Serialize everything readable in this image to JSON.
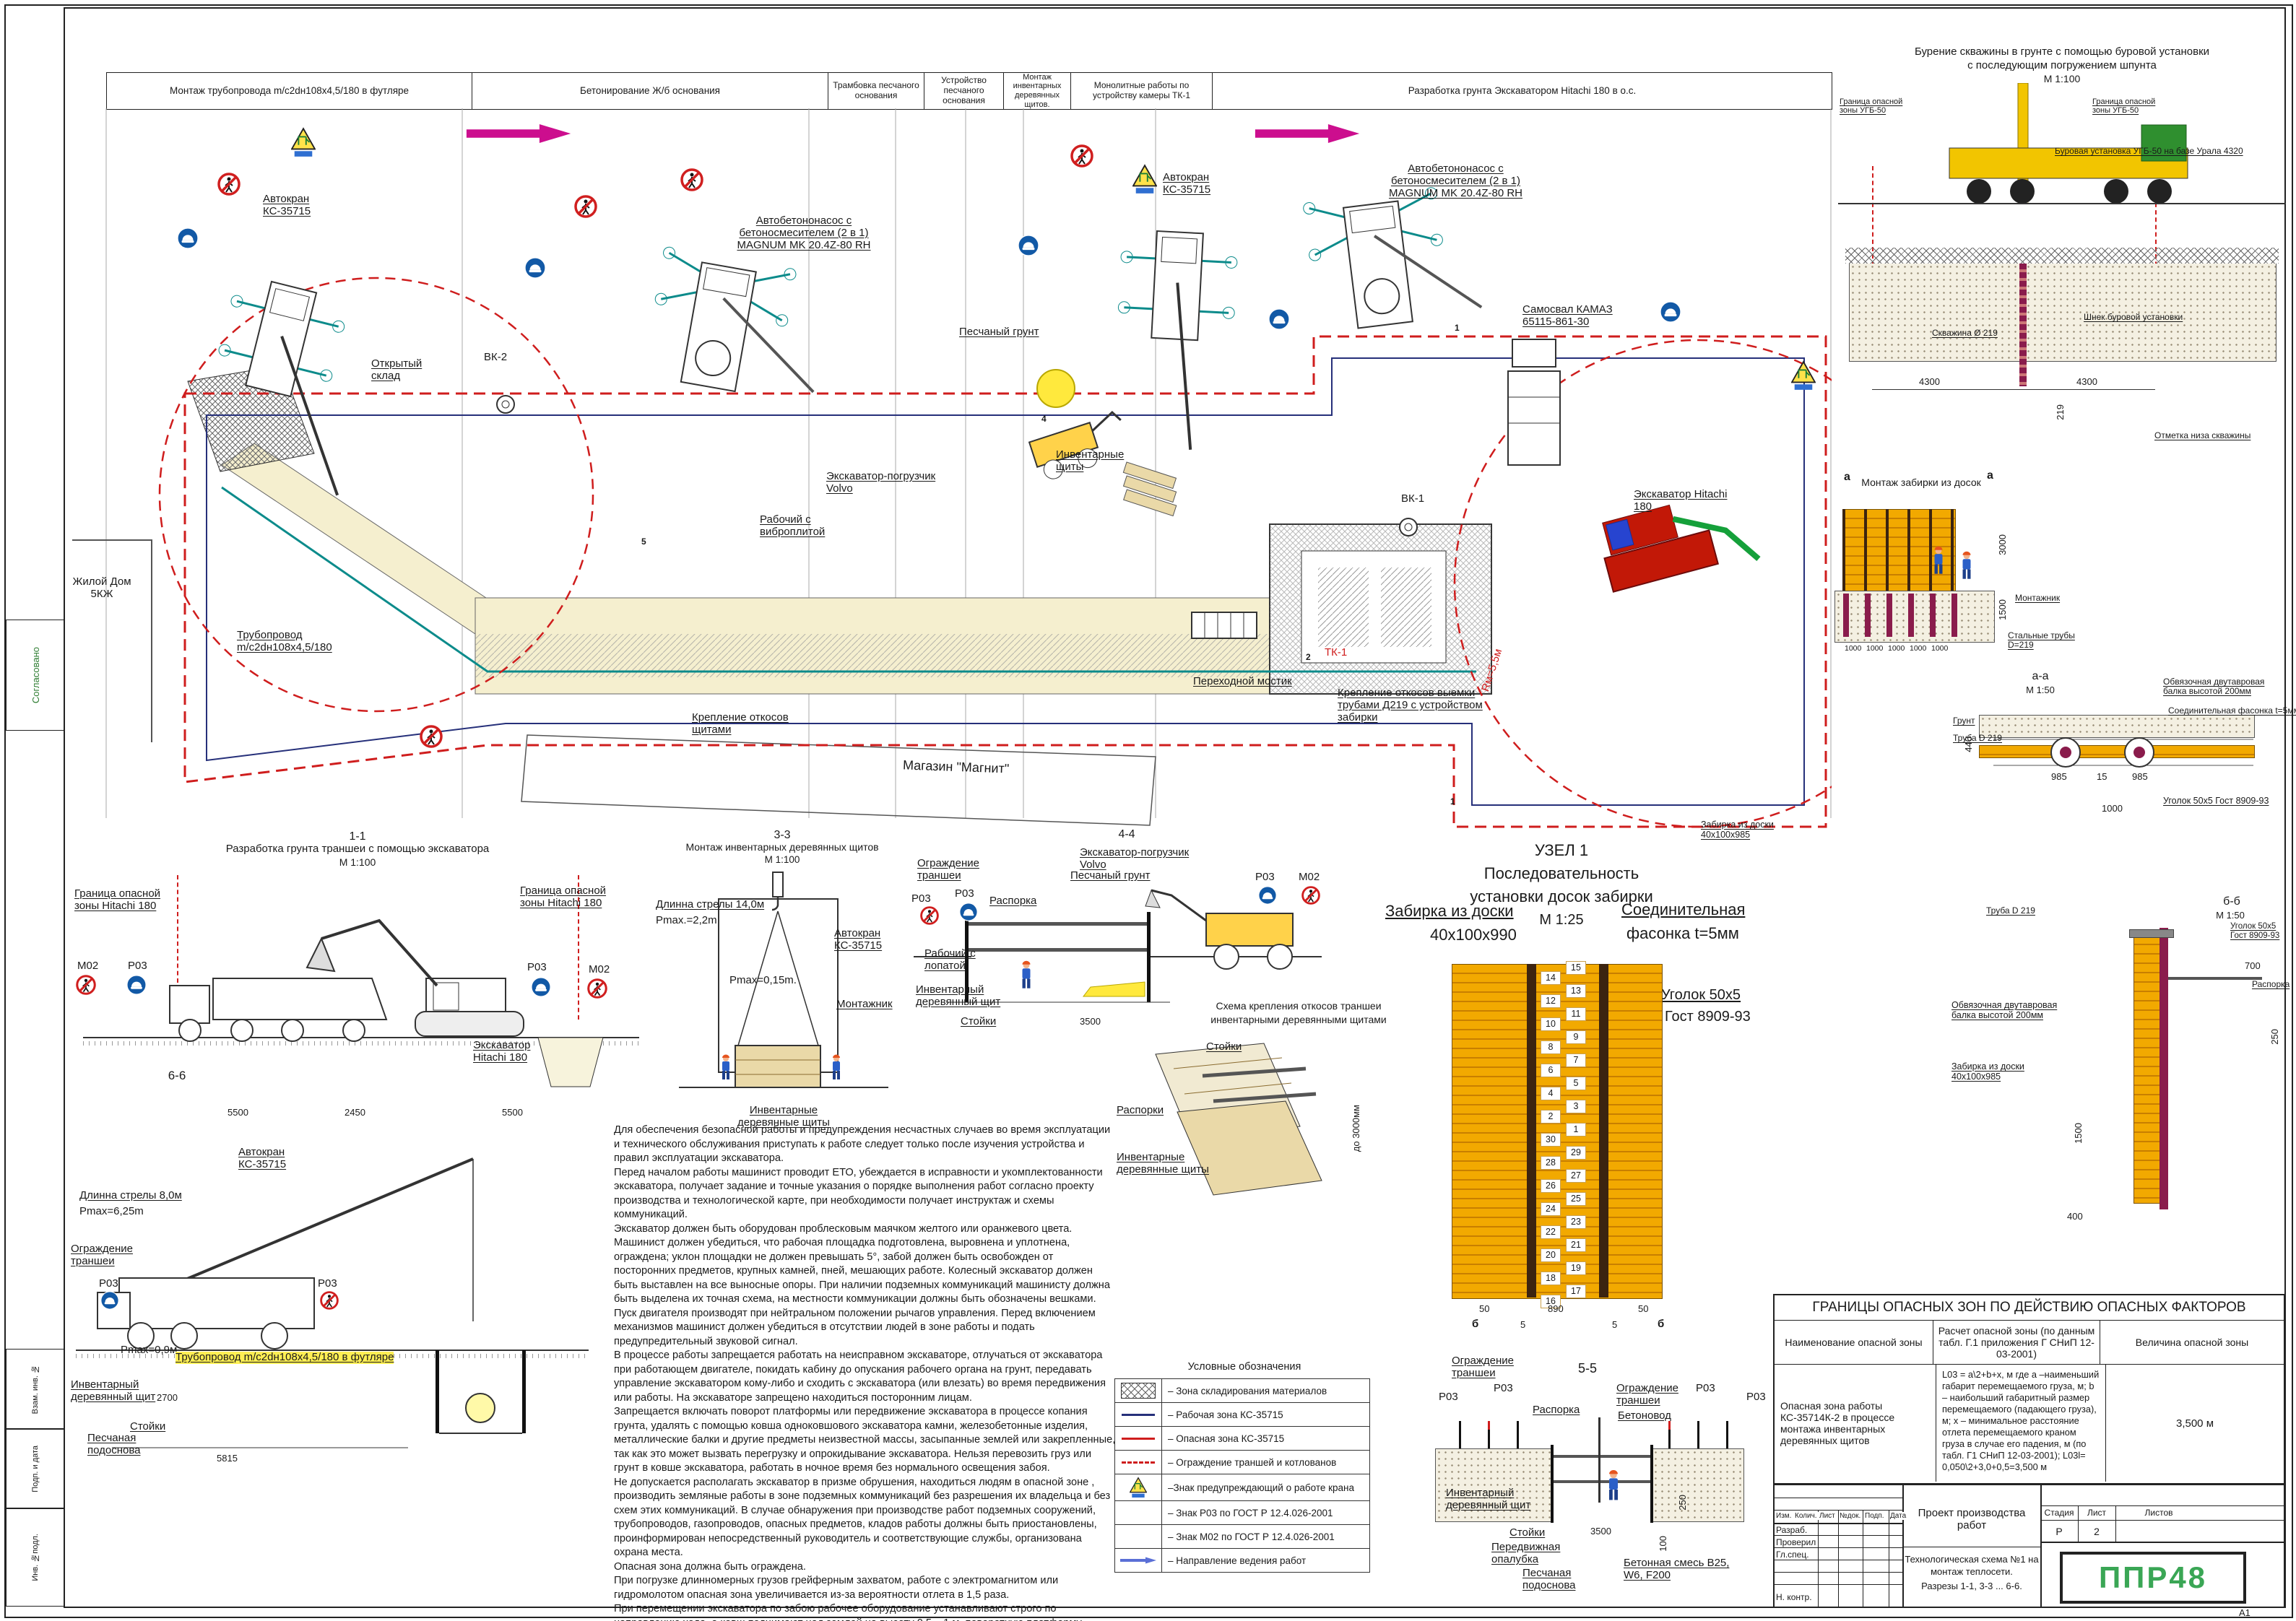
{
  "sheet": {
    "format_label": "А1"
  },
  "side_strip": {
    "approved": "Согласовано",
    "vzam": "Взам. инв. №",
    "podp": "Подп. и дата",
    "inv": "Инв. №подл."
  },
  "stage_header": {
    "columns": [
      "Монтаж трубопровода m/c2dн108х4,5/180 в футляре",
      "Бетонирование Ж/б основания",
      "Трамбовка песчаного основания",
      "Устройство песчаного основания",
      "Монтаж инвентарных деревянных щитов.",
      "Монолитные работы по устройству камеры ТК-1",
      "Разработка грунта Экскаватором Hitachi 180 в о.с."
    ]
  },
  "signs": {
    "p03": "Р03",
    "m02": "М02"
  },
  "plan": {
    "labels": {
      "zhiloy_dom": "Жилой Дом 5КЖ",
      "pipeline": "Трубопровод m/c2dн108х4,5/180",
      "open_storage": "Открытый склад",
      "vk2": "ВК-2",
      "crane": "Автокран КС-35715",
      "pump": "Автобетононасос с бетоносмесителем (2 в 1) MAGNUM MK 20.4Z-80 RH",
      "sand": "Песчаный грунт",
      "shields": "Инвентарные щиты",
      "volvo": "Экскаватор-погрузчик Volvo",
      "vibro": "Рабочий с виброплитой",
      "kamaz": "Самосвал КАМАЗ 65115-861-30",
      "hitachi": "Экскаватор Hitachi 180",
      "vk1": "ВК-1",
      "tk1": "ТК-1",
      "bridge": "Переходной мостик",
      "slope_pipes": "Крепление откосов выемки трубами Д219 с устройством забирки",
      "slope_shields": "Крепление откосов щитами",
      "magnit": "Магазин \"Магнит\"",
      "radius": "Rм=5,5м"
    },
    "marks": {
      "m1": "1",
      "m2": "2",
      "m4": "4",
      "m5": "5"
    }
  },
  "drilling": {
    "title1": "Бурение скважины в грунте с помощью буровой установки",
    "title2": "с последующим погружением шпунта",
    "scale": "М 1:100",
    "boundary": "Граница опасной зоны УГБ-50",
    "rig": "Буровая установка УГБ-50 на базе Урала 4320",
    "auger": "Шнек буровой установки",
    "borehole": "Скважина Ø 219",
    "bottom_mark": "Отметка низа скважины",
    "d4300": "4300",
    "d219": "219"
  },
  "boards_montage": {
    "title": "Монтаж забирки из досок",
    "mark": "а",
    "fitter": "Монтажник",
    "pipes": "Стальные трубы D=219",
    "d3000": "3000",
    "d1500": "1500",
    "d1000": "1000"
  },
  "section_aa": {
    "title": "а-а",
    "scale": "М 1:50",
    "ground": "Грунт",
    "pipe": "Труба D 219",
    "beam": "Обвязочная двутавровая балка высотой 200мм",
    "gusset": "Соединительная фасонка t=5мм",
    "board": "Забирка из доски 40х100х985",
    "corner": "Уголок 50х5 Гост 8909-93",
    "d985": "985",
    "d15": "15",
    "d1000": "1000",
    "d440": "440"
  },
  "section_bb": {
    "title": "б-б",
    "scale": "М 1:50",
    "pipe": "Труба D 219",
    "corner": "Уголок 50х5 Гост 8909-93",
    "spacer": "Распорка",
    "beam": "Обвязочная двутавровая балка высотой 200мм",
    "board": "Забирка из доски 40х100х985",
    "d700": "700",
    "d250": "250",
    "d1500": "1500",
    "d400": "400"
  },
  "s11": {
    "num": "1-1",
    "title": "Разработка грунта траншеи с помощью экскаватора",
    "scale": "М 1:100",
    "boundary": "Граница опасной зоны Hitachi 180",
    "excavator": "Экскаватор Hitachi 180",
    "d5500": "5500",
    "d2450": "2450"
  },
  "s33": {
    "num": "3-3",
    "title": "Монтаж инвентарных деревянных щитов",
    "scale": "М 1:100",
    "boom": "Длинна стрелы 14,0м",
    "pmax1": "Pmax.=2,2m",
    "crane": "Автокран КС-35715",
    "pmax2": "Pmax=0,15m.",
    "fitter": "Монтажник",
    "shields": "Инвентарные деревянные щиты"
  },
  "s44": {
    "num": "4-4",
    "volvo": "Экскаватор-погрузчик Volvo",
    "fence": "Ограждение траншеи",
    "sand": "Песчаный грунт",
    "spacer": "Распорка",
    "worker": "Рабочий с лопатой",
    "shield": "Инвентарный деревянный щит",
    "stands": "Стойки",
    "d3500": "3500"
  },
  "s55": {
    "num": "5-5",
    "fence": "Ограждение траншеи",
    "spacer": "Распорка",
    "pipe": "Бетоновод",
    "shield": "Инвентарный деревянный щит",
    "stands": "Стойки",
    "formwork": "Передвижная опалубка",
    "base": "Песчаная подоснова",
    "mix": "Бетонная смесь В25, W6, F200",
    "d3500": "3500",
    "d250": "250",
    "d100": "100"
  },
  "s66": {
    "num": "6-6",
    "crane": "Автокран КС-35715",
    "boom": "Длинна стрелы 8,0м",
    "pmax1": "Pmax=6,25m",
    "fence": "Ограждение траншеи",
    "pmax2": "Pmax=0,9м",
    "pipe": "Трубопровод m/c2dн108х4,5/180 в футляре",
    "shield": "Инвентарный деревянный щит",
    "stands": "Стойки",
    "base": "Песчаная подоснова",
    "d2700": "2700",
    "d5815": "5815"
  },
  "uzel1": {
    "num": "УЗЕЛ 1",
    "sub1": "Последовательность",
    "sub2": "установки досок забирки",
    "scale": "М 1:25",
    "board1": "Забирка из доски",
    "board2": "40х100х990",
    "gusset1": "Соединительная",
    "gusset2": "фасонка t=5мм",
    "corner1": "Уголок 50х5",
    "corner2": "Гост 8909-93",
    "mark": "б",
    "d50": "50",
    "d890": "890",
    "d5": "5",
    "numbers_left": [
      "14",
      "12",
      "10",
      "8",
      "6",
      "4",
      "2",
      "30",
      "28",
      "26",
      "24",
      "22",
      "20",
      "18",
      "16"
    ],
    "numbers_right": [
      "15",
      "13",
      "11",
      "9",
      "7",
      "5",
      "3",
      "1",
      "29",
      "27",
      "25",
      "23",
      "21",
      "19",
      "17"
    ]
  },
  "slope_scheme": {
    "title1": "Схема крепления откосов траншеи",
    "title2": "инвентарными деревянными щитами",
    "stands": "Стойки",
    "spacers": "Распорки",
    "shields": "Инвентарные деревянные щиты",
    "height": "до 3000мм"
  },
  "safety_text": {
    "paragraphs": [
      "Для обеспечения безопасной работы и предупреждения несчастных случаев во время эксплуатации и технического обслуживания приступать к работе следует только после изучения устройства и правил эксплуатации экскаватора.",
      "Перед началом работы машинист проводит ЕТО, убеждается в исправности и укомплектованности экскаватора, получает задание и точные указания о порядке выполнения работ согласно проекту производства и технологической карте, при необходимости получает инструктаж и схемы коммуникаций.",
      "Экскаватор должен быть оборудован проблесковым маячком желтого или оранжевого цвета.",
      "Машинист должен убедиться, что рабочая площадка подготовлена, выровнена и уплотнена, ограждена; уклон площадки не должен превышать 5°, забой должен быть освобожден от посторонних предметов, крупных камней, пней, мешающих работе. Колесный экскаватор должен быть выставлен на все выносные опоры. При наличии подземных коммуникаций машинисту должна быть выделена их точная схема, на местности коммуникации должны быть обозначены вешками.",
      "Пуск двигателя производят при нейтральном положении рычагов управления. Перед включением механизмов машинист должен убедиться в отсутствии людей в зоне работы и подать предупредительный звуковой сигнал.",
      "В процессе работы запрещается работать на неисправном экскаваторе, отлучаться от экскаватора при работающем двигателе, покидать кабину до опускания рабочего органа на грунт, передавать управление экскаватором кому-либо и сходить с экскаватора (или влезать) во время передвижения или работы. На экскаваторе запрещено находиться посторонним лицам.",
      "Запрещается включать поворот платформы или передвижение экскаватора в процессе копания грунта, удалять с помощью ковша одноковшового экскаватора камни, железобетонные изделия, металлические балки и другие предметы неизвестной массы, засыпанные землей или закрепленные, так как это может вызвать перегрузку и опрокидывание экскаватора. Нельзя перевозить груз или грунт в ковше экскаватора, работать в ночное время без нормального освещения забоя.",
      "Не допускается располагать экскаватор в призме обрушения, находиться людям в опасной зоне , производить земляные работы в зоне подземных коммуникаций без разрешения их владельца и без схем этих коммуникаций. В случае обнаружения при производстве работ подземных сооружений, трубопроводов, газопроводов, опасных предметов, кладов работы должны быть приостановлены, проинформирован непосредственный руководитель и соответствующие службы, организована охрана места.",
      "Опасная зона должна быть ограждена.",
      "При погрузке длинномерных грузов грейферным захватом, работе с электромагнитом или гидромолотом опасная зона увеличивается из-за вероятности отлета в 1,5 раза.",
      "При перемещении экскаватора по забою рабочее оборудование устанавливают строго по направлению хода, а ковш поднимают над землей на высоту 0,5... 1 м, поворотную платформу застопоривают.",
      "При складировании грунта в отвал вдоль откоса траншеи расстояние от бровки до отвала — не менее 0,5 м, высота отвала — не более 2 м."
    ]
  },
  "legend": {
    "title": "Условные обозначения",
    "items": [
      {
        "icon": "storage-hatch",
        "label": "– Зона складирования материалов"
      },
      {
        "icon": "work-zone-line",
        "label": "– Рабочая зона КС-35715"
      },
      {
        "icon": "danger-zone-line",
        "label": "– Опасная зона КС-35715"
      },
      {
        "icon": "trench-fence-line",
        "label": "– Ограждение траншей и котлованов"
      },
      {
        "icon": "crane-warning",
        "label": "–Знак предупреждающий о работе крана"
      },
      {
        "icon": "none",
        "label": "– Знак Р03 по ГОСТ Р 12.4.026-2001"
      },
      {
        "icon": "none",
        "label": "– Знак М02 по ГОСТ Р 12.4.026-2001"
      },
      {
        "icon": "direction-arrow",
        "label": "– Направление ведения работ"
      }
    ]
  },
  "danger_table": {
    "title": "ГРАНИЦЫ ОПАСНЫХ ЗОН ПО ДЕЙСТВИЮ ОПАСНЫХ ФАКТОРОВ",
    "col_name": "Наименование опасной зоны",
    "col_calc": "Расчет опасной зоны (по данным табл. Г.1 приложения Г СНиП 12-03-2001)",
    "col_value": "Величина опасной зоны",
    "row_name": "Опасная зона работы КС-35714К-2 в процессе монтажа инвентарных деревянных щитов",
    "row_calc": "L03 = a\\2+b+x, м где а –наименьший габарит перемещаемого груза, м; b – наибольший габаритный размер перемещаемого (падающего груза), м; х – минимальное расстояние отлета перемещаемого краном груза в случае его падения, м (по табл. Г1 СНиП 12-03-2001); L03l= 0,050\\2+3,0+0,5=3,500 м",
    "row_value": "3,500 м"
  },
  "title_block": {
    "cols": [
      "Изм.",
      "Колич.",
      "Лист",
      "№док.",
      "Подп.",
      "Дата"
    ],
    "rows": [
      "Разраб.",
      "Проверил",
      "Гл.спец.",
      "",
      "",
      "Н. контр."
    ],
    "project": "Проект производства работ",
    "doc1": "Технологическая схема №1 на монтаж теплосети.",
    "doc2": "Разрезы 1-1, 3-3 ... 6-6.",
    "stage_h": "Стадия",
    "sheet_h": "Лист",
    "sheets_h": "Листов",
    "stage": "Р",
    "sheet_no": "2",
    "logo": "ППР48"
  },
  "colors": {
    "danger_red": "#cf1d1d",
    "work_blue": "#26307a",
    "direction_magenta": "#cc0e8e",
    "board_orange": "#f2a900",
    "pipe_maroon": "#8a1c4c",
    "sign_blue": "#1259a6",
    "logo_green": "#3aa655",
    "trench_beige": "#f5efcf"
  }
}
